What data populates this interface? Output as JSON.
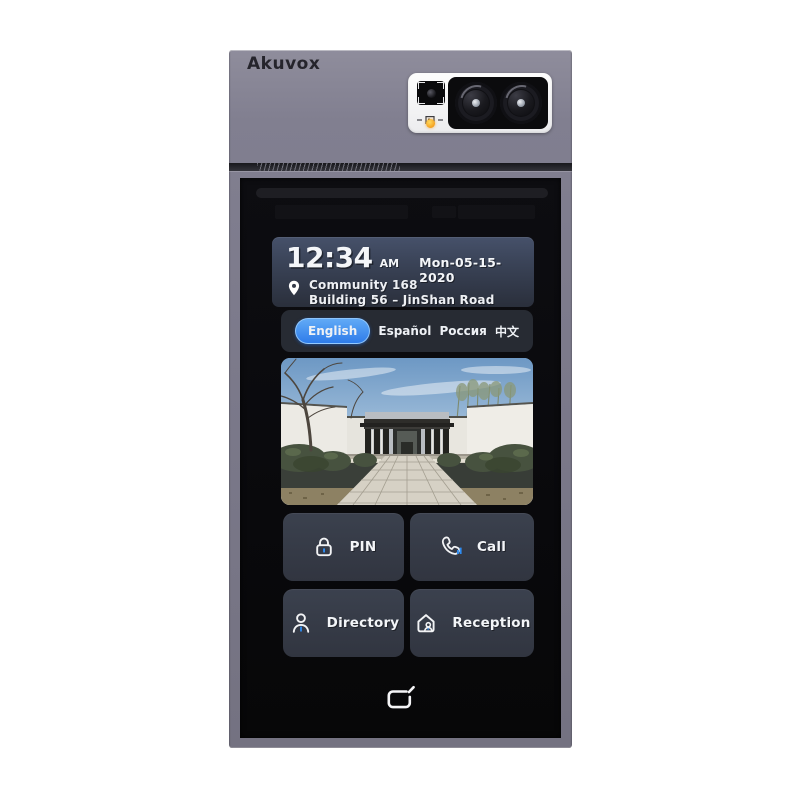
{
  "device": {
    "brand": "Akuvox"
  },
  "status": {
    "time": "12:34",
    "meridiem": "AM",
    "date": "Mon-05-15-2020",
    "location_line1": "Community 168",
    "location_line2": "Building 56 – JinShan Road"
  },
  "languages": {
    "items": [
      {
        "label": "English",
        "selected": true
      },
      {
        "label": "Español",
        "selected": false
      },
      {
        "label": "Россия",
        "selected": false
      },
      {
        "label": "中文",
        "selected": false
      }
    ]
  },
  "photo": {
    "alt": "Community entrance: dark-roof pavilion gate, white walls, paved walkway, trees and reflecting pools"
  },
  "buttons": [
    {
      "id": "pin",
      "label": "PIN",
      "icon": "lock-icon"
    },
    {
      "id": "call",
      "label": "Call",
      "icon": "phone-icon"
    },
    {
      "id": "directory",
      "label": "Directory",
      "icon": "person-icon"
    },
    {
      "id": "reception",
      "label": "Reception",
      "icon": "house-person-icon"
    }
  ],
  "icons": {
    "location": "map-pin-icon",
    "reader": "rfid-card-reader-icon",
    "front_camera": "front-camera",
    "status_led": "status-led",
    "qr": "qr-indicator-icon"
  },
  "colors": {
    "accent_blue": "#2f8df2",
    "selected_pill_top": "#61aaf6",
    "selected_pill_bottom": "#2e7cea",
    "panel_gray": "#7b7989",
    "card_top": "#46516a",
    "card_bottom": "#2a2f3b",
    "button_bg": "#363c49",
    "screen_black": "#0a0a0d"
  }
}
